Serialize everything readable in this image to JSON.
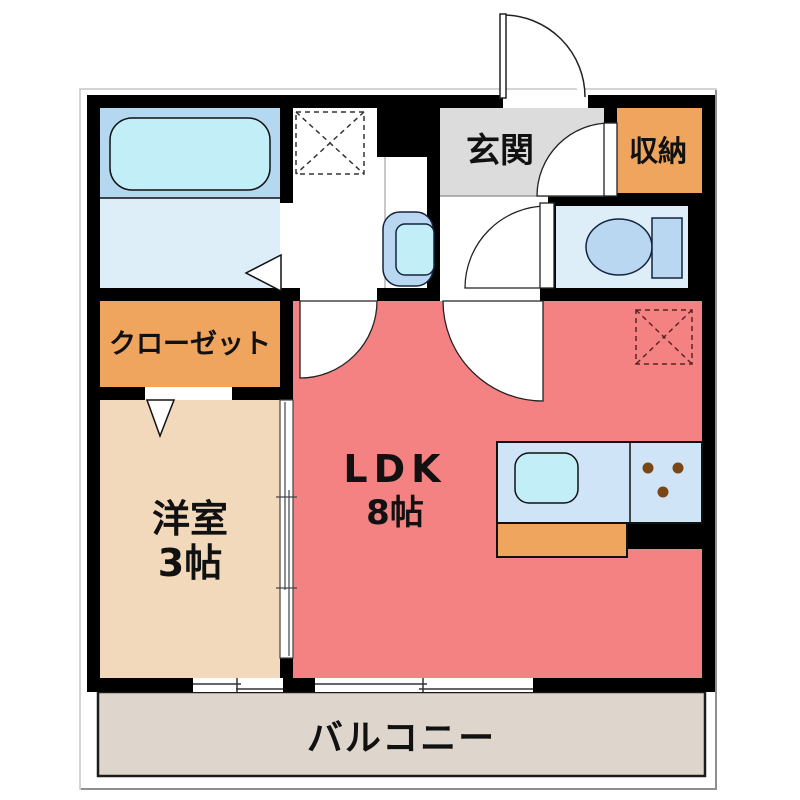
{
  "plan_title": "1LDK apartment floor plan",
  "rooms": {
    "entrance": {
      "label": "玄関"
    },
    "storage": {
      "label": "収納"
    },
    "closet": {
      "label": "クローゼット"
    },
    "western_room": {
      "label": "洋室",
      "size": "3帖"
    },
    "ldk": {
      "label": "LDK",
      "size": "8帖"
    },
    "balcony": {
      "label": "バルコニー"
    }
  },
  "colors": {
    "wall": "#000000",
    "ldk_pink": "#f58283",
    "western_room_tan": "#f3d9bc",
    "closet_orange": "#f0a55e",
    "storage_orange": "#f0a55e",
    "cabinet_orange": "#f0a55e",
    "entrance_gray": "#dcdcdc",
    "balcony_gray": "#ded6cd",
    "bath_zone_blue": "#b4d8f0",
    "fixture_blue": "#b9d7f0",
    "tub_water_cyan": "#c2eef8",
    "wet_floor_blue": "#ddeef9",
    "counter_blue": "#cfe4f7",
    "burner_brown": "#7a4613",
    "door_white": "#ffffff"
  }
}
